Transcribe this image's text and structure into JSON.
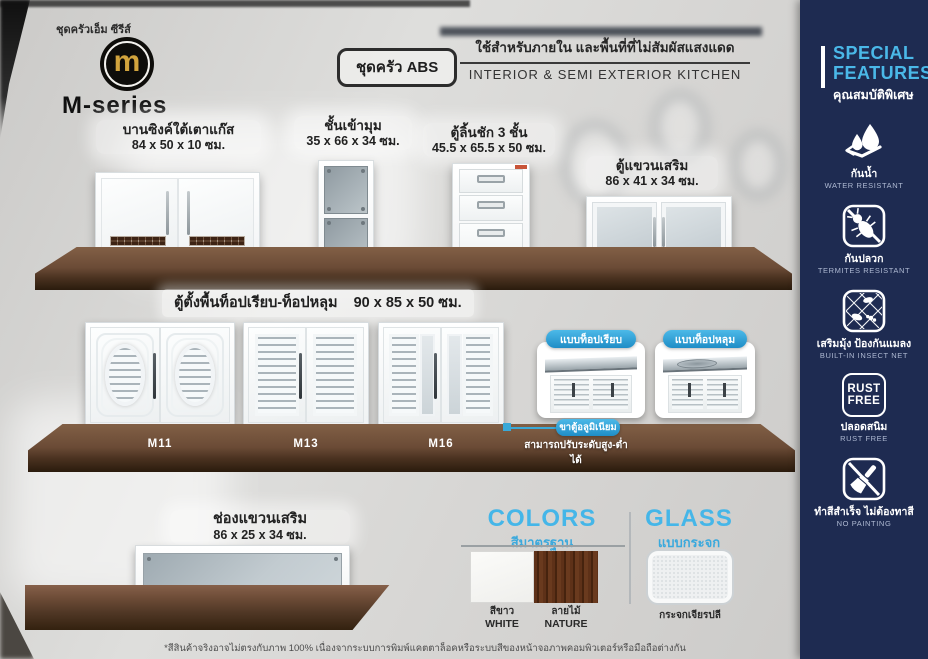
{
  "brand": {
    "series_label": "ชุดครัวเอ็ม ซีรีส์",
    "logo_letter": "m",
    "name": "M-series"
  },
  "header": {
    "badge": "ชุดครัว ABS",
    "usage_th": "ใช้สำหรับภายใน และพื้นที่ที่ไม่สัมผัสแสงแดด",
    "usage_en": "INTERIOR & SEMI EXTERIOR KITCHEN"
  },
  "sidebar": {
    "title_line1": "SPECIAL",
    "title_line2": "FEATURES",
    "title_th": "คุณสมบัติพิเศษ",
    "features": [
      {
        "icon": "water-resistant-icon",
        "th": "กันน้ำ",
        "en": "WATER RESISTANT"
      },
      {
        "icon": "termites-resistant-icon",
        "th": "กันปลวก",
        "en": "TERMITES RESISTANT"
      },
      {
        "icon": "insect-net-icon",
        "th": "เสริมมุ้ง ป้องกันแมลง",
        "en": "BUILT-IN INSECT NET"
      },
      {
        "icon": "rust-free-icon",
        "icon_line1": "RUST",
        "icon_line2": "FREE",
        "th": "ปลอดสนิม",
        "en": "RUST FREE"
      },
      {
        "icon": "no-painting-icon",
        "th": "ทำสีสำเร็จ ไม่ต้องทาสี",
        "en": "NO PAINTING"
      }
    ]
  },
  "row1": [
    {
      "name": "บานซิงค์ใต้เตาแก๊ส",
      "size": "84 x 50 x 10 ซม."
    },
    {
      "name": "ชั้นเข้ามุม",
      "size": "35 x 66 x 34 ซม."
    },
    {
      "name": "ตู้ลิ้นชัก 3 ชั้น",
      "size": "45.5 x 65.5 x 50 ซม."
    },
    {
      "name": "ตู้แขวนเสริม",
      "size": "86 x 41 x 34 ซม."
    }
  ],
  "row2": {
    "title": "ตู้ตั้งพื้นท็อปเรียบ-ท็อปหลุม",
    "size": "90 x 85 x 50 ซม.",
    "models": [
      "M11",
      "M13",
      "M16"
    ],
    "top_types": [
      {
        "label": "แบบท็อปเรียบ"
      },
      {
        "label": "แบบท็อปหลุม"
      }
    ],
    "leg_callout": {
      "pill": "ขาตู้อลูมิเนียม",
      "note": "สามารถปรับระดับสูง-ต่ำได้"
    }
  },
  "row3": {
    "name": "ช่องแขวนเสริม",
    "size": "86 x 25 x 34 ซม."
  },
  "options": {
    "colors": {
      "title_en": "COLORS",
      "title_th": "สีมาตรฐาน",
      "swatches": [
        {
          "th": "สีขาว",
          "en": "WHITE",
          "hex": "#f5f5f2"
        },
        {
          "th": "ลายไม้",
          "en": "NATURE",
          "hex": "#542c13"
        }
      ]
    },
    "glass": {
      "title_en": "GLASS",
      "title_th": "แบบกระจก",
      "sample_label": "กระจกเจียรปลี"
    }
  },
  "footnote": "*สีสินค้าจริงอาจไม่ตรงกับภาพ 100% เนื่องจากระบบการพิมพ์แคตตาล็อคหรือระบบสีของหน้าจอภาพคอมพิวเตอร์หรือมือถือต่างกัน",
  "palette": {
    "accent_blue": "#45b6e8",
    "sidebar_navy": "#1e2b51",
    "counter_brown": "#6b4b36",
    "logo_gold": "#d2a43d"
  }
}
